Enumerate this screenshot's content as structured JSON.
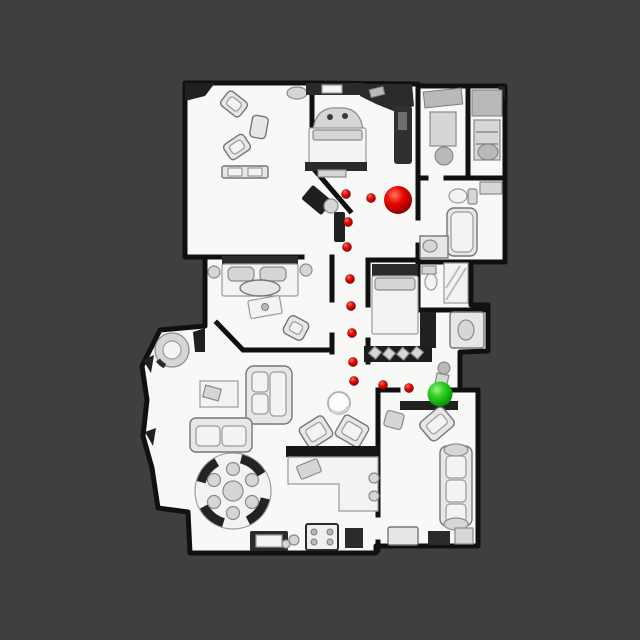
{
  "scene": {
    "view": "top-down-3d-scan-floorplan",
    "background_color": "#3f3f3f",
    "floor_color": "#f8f8f7",
    "wall_color": "#101010",
    "path": {
      "dot_color": "#e00800",
      "dot_radius": 4.6,
      "waypoints": [
        [
          346,
          194
        ],
        [
          371,
          198
        ],
        [
          348,
          222
        ],
        [
          347,
          247
        ],
        [
          350,
          279
        ],
        [
          351,
          306
        ],
        [
          352,
          333
        ],
        [
          353,
          362
        ],
        [
          354,
          381
        ],
        [
          383,
          385
        ],
        [
          409,
          388
        ]
      ]
    },
    "markers": [
      {
        "id": "red-sphere",
        "color": "#e00000",
        "x": 398,
        "y": 200,
        "radius": 14
      },
      {
        "id": "green-sphere",
        "color": "#1ec41e",
        "x": 440,
        "y": 394,
        "radius": 12.5
      }
    ]
  }
}
